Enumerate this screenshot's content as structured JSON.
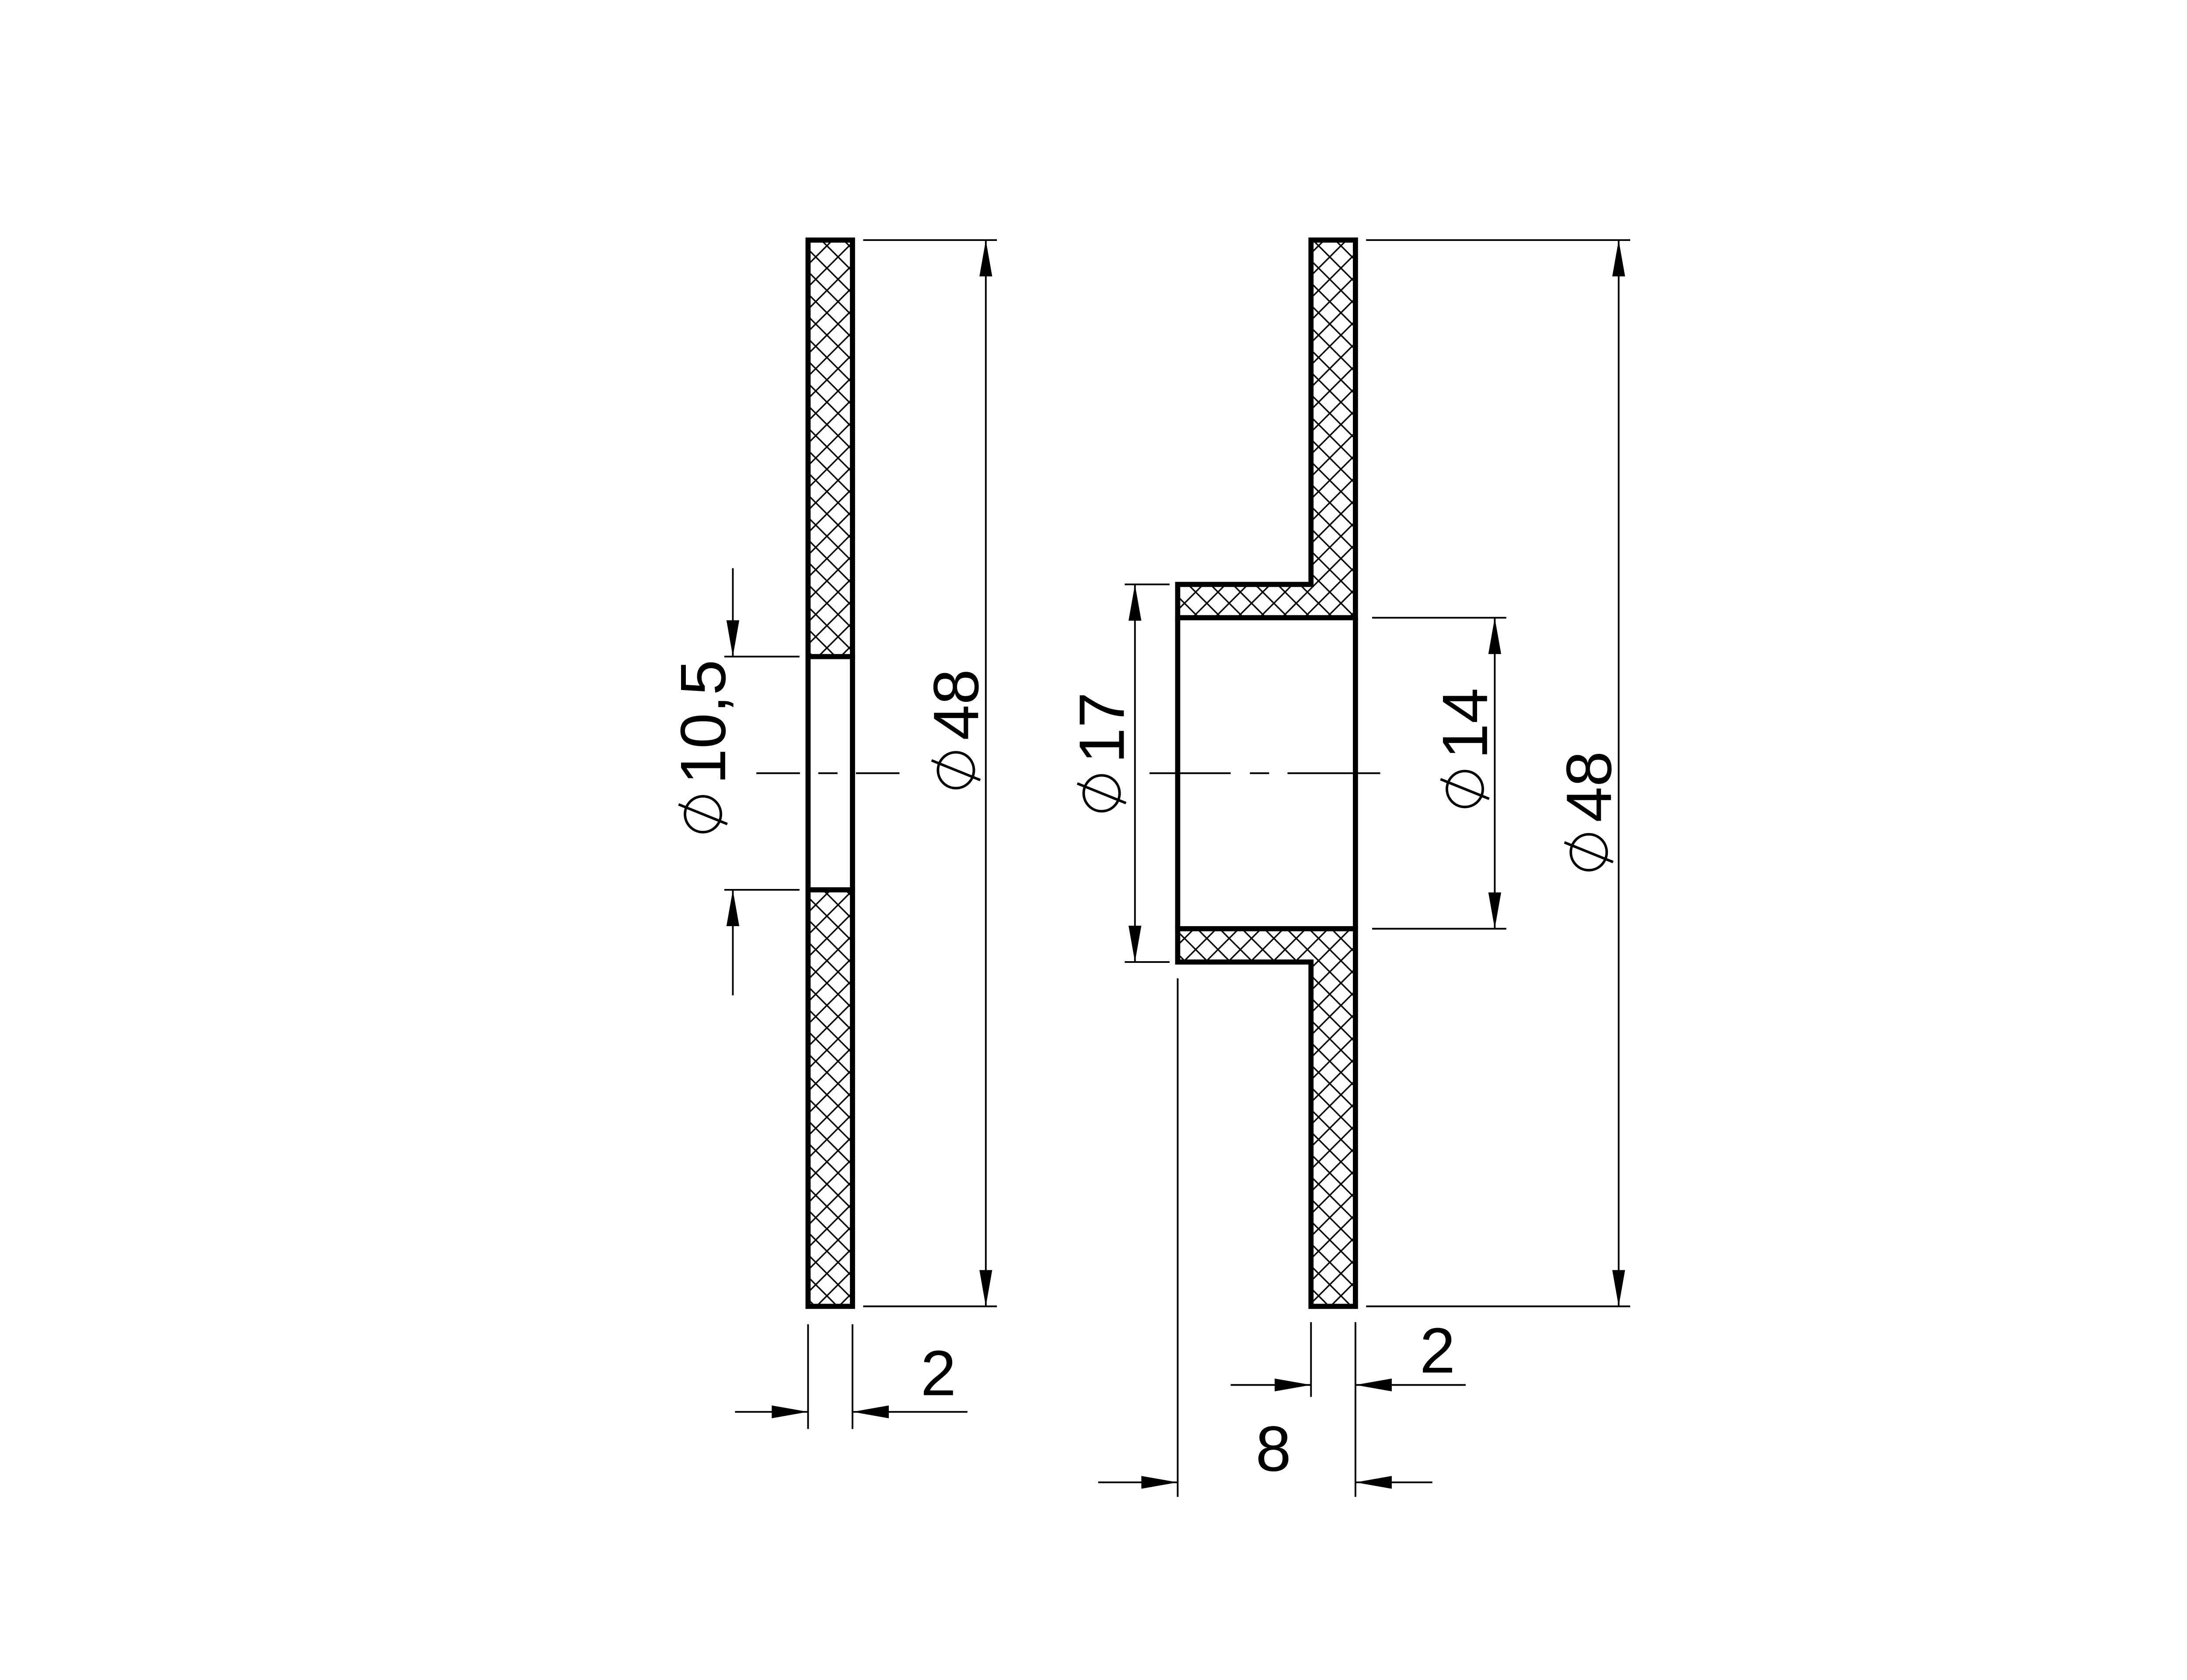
{
  "drawing": {
    "background_color": "#ffffff",
    "line_color": "#000000",
    "views": [
      {
        "name": "washer-section",
        "dimensions": {
          "bore": {
            "symbol": "diameter",
            "value": "10,5"
          },
          "outer_diameter": {
            "symbol": "diameter",
            "value": "48"
          },
          "thickness": {
            "value": "2"
          }
        }
      },
      {
        "name": "flanged-bushing-section",
        "dimensions": {
          "hub_outer_diameter": {
            "symbol": "diameter",
            "value": "17"
          },
          "bore": {
            "symbol": "diameter",
            "value": "14"
          },
          "flange_outer_diameter": {
            "symbol": "diameter",
            "value": "48"
          },
          "flange_thickness": {
            "value": "2"
          },
          "overall_length": {
            "value": "8"
          }
        }
      }
    ]
  }
}
